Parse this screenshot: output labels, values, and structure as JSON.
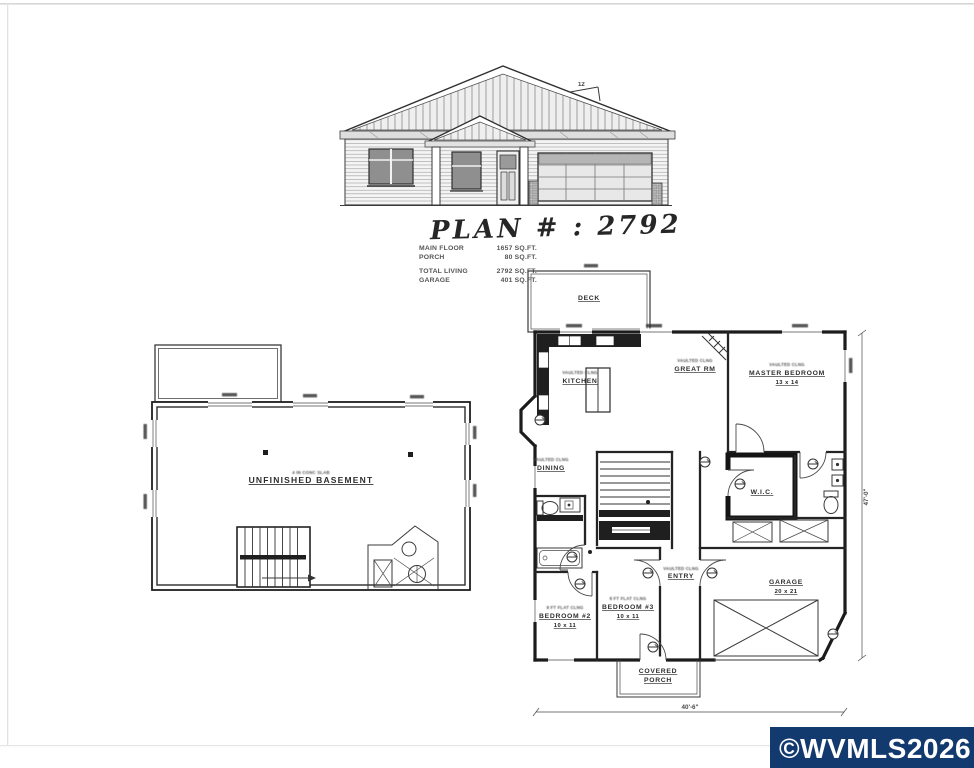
{
  "page": {
    "background": "#ffffff",
    "ink": "#2f2f2f"
  },
  "plan_header": {
    "title": "PLAN # : 2792"
  },
  "stats": {
    "rows": [
      {
        "label": "MAIN FLOOR",
        "value": "1657 SQ.FT."
      },
      {
        "label": "PORCH",
        "value": "80 SQ.FT."
      },
      {
        "label": "TOTAL LIVING",
        "value": "2792 SQ.FT."
      },
      {
        "label": "GARAGE",
        "value": "401 SQ.FT."
      }
    ]
  },
  "elevation": {
    "pitch_label": "12"
  },
  "basement": {
    "slab_note": "4 IN CONC SLAB",
    "room_label": "UNFINISHED BASEMENT"
  },
  "main_floor": {
    "deck": "DECK",
    "kitchen_note": "VAULTED CLNG",
    "kitchen": "KITCHEN",
    "great_note": "VAULTED CLNG",
    "great": "GREAT RM",
    "master_note": "VAULTED CLNG",
    "master": "MASTER BEDROOM",
    "master_size": "13 x 14",
    "dining_note": "VAULTED CLNG",
    "dining": "DINING",
    "bed2_note": "8 FT FLAT CLNG",
    "bed2": "BEDROOM #2",
    "bed2_size": "10 x 11",
    "bed3_note": "8 FT FLAT CLNG",
    "bed3": "BEDROOM #3",
    "bed3_size": "10 x 11",
    "entry_note": "VAULTED CLNG",
    "entry": "ENTRY",
    "wic": "W.I.C.",
    "garage": "GARAGE",
    "garage_size": "20 x 21",
    "porch_line1": "COVERED",
    "porch_line2": "PORCH",
    "dim_right": "47'-0\"",
    "dim_bottom": "40'-6\""
  },
  "watermark": {
    "text": "©WVMLS2026",
    "bg": "#133A6F",
    "fg": "#FFFFFF"
  }
}
